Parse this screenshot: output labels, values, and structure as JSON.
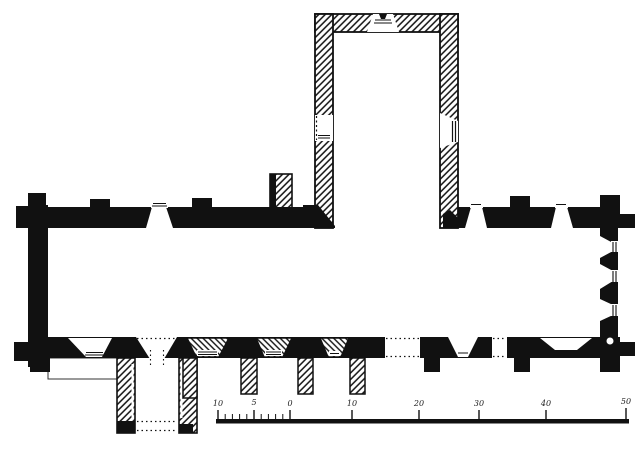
{
  "figure": {
    "ink_color": "#111111",
    "paper_color": "#ffffff"
  },
  "scale_bar": {
    "unit_labels": [
      "10",
      "5",
      "0",
      "10",
      "20",
      "30",
      "40",
      "50"
    ]
  }
}
